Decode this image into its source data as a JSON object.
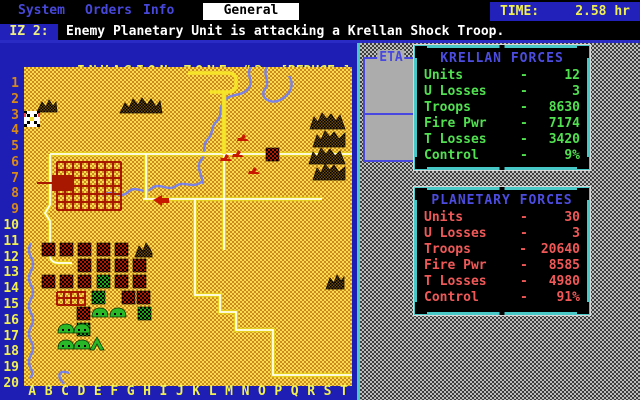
{
  "menu": {
    "items": [
      {
        "label": "System",
        "active": false
      },
      {
        "label": "Orders",
        "active": false
      },
      {
        "label": "Info",
        "active": false
      },
      {
        "label": "General",
        "active": true
      }
    ],
    "time_label": "TIME:",
    "time_value": "2.58 hr"
  },
  "message": {
    "prefix": "IZ 2:",
    "text": "Enemy Planetary Unit is attacking a Krellan Shock Troop."
  },
  "map": {
    "title": "INVASION ZONE #2",
    "reduce_button": "[REDUCE ]",
    "row_labels": [
      "1",
      "2",
      "3",
      "4",
      "5",
      "6",
      "7",
      "8",
      "9",
      "10",
      "11",
      "12",
      "13",
      "14",
      "15",
      "16",
      "17",
      "18",
      "19",
      "20"
    ],
    "col_labels": [
      "A",
      "B",
      "C",
      "D",
      "E",
      "F",
      "G",
      "H",
      "I",
      "J",
      "K",
      "L",
      "M",
      "N",
      "O",
      "P",
      "Q",
      "R",
      "S",
      "T"
    ]
  },
  "eta": {
    "title": "ETA"
  },
  "panels": [
    {
      "id": "krellan",
      "title": "KRELLAN FORCES",
      "rows": [
        {
          "label": "Units",
          "value": "12"
        },
        {
          "label": "U Losses",
          "value": "3"
        },
        {
          "label": "Troops",
          "value": "8630"
        },
        {
          "label": "Fire Pwr",
          "value": "7174"
        },
        {
          "label": "T Losses",
          "value": "3420"
        },
        {
          "label": "Control",
          "value": "9%"
        }
      ]
    },
    {
      "id": "planetary",
      "title": "PLANETARY FORCES",
      "rows": [
        {
          "label": "Units",
          "value": "30"
        },
        {
          "label": "U Losses",
          "value": "3"
        },
        {
          "label": "Troops",
          "value": "20640"
        },
        {
          "label": "Fire Pwr",
          "value": "8585"
        },
        {
          "label": "T Losses",
          "value": "4980"
        },
        {
          "label": "Control",
          "value": "91%"
        }
      ]
    }
  ],
  "colors": {
    "menu_text": "#4747d9",
    "time_bg": "#2222bb",
    "time_text": "#f0f050",
    "message_text": "#ffffff",
    "map_frame_blue": "#1e1eb4",
    "map_title_yellow": "#f0f050",
    "row_label_single": "#d88a18",
    "row_label_double": "#f0f050",
    "terrain_light": "#f5dd4d",
    "terrain_dark": "#ce8a1c",
    "river_blue": "#7a82e8",
    "road_core": "#fffff0",
    "road_edge": "#e8d020",
    "city_red": "#a81800",
    "panel_border_cyan": "#49c8c8",
    "panel_title_blue": "#4c4ce0",
    "krellan_text": "#50e050",
    "planetary_text": "#f05858",
    "background_gray": "#bdbdbd"
  }
}
